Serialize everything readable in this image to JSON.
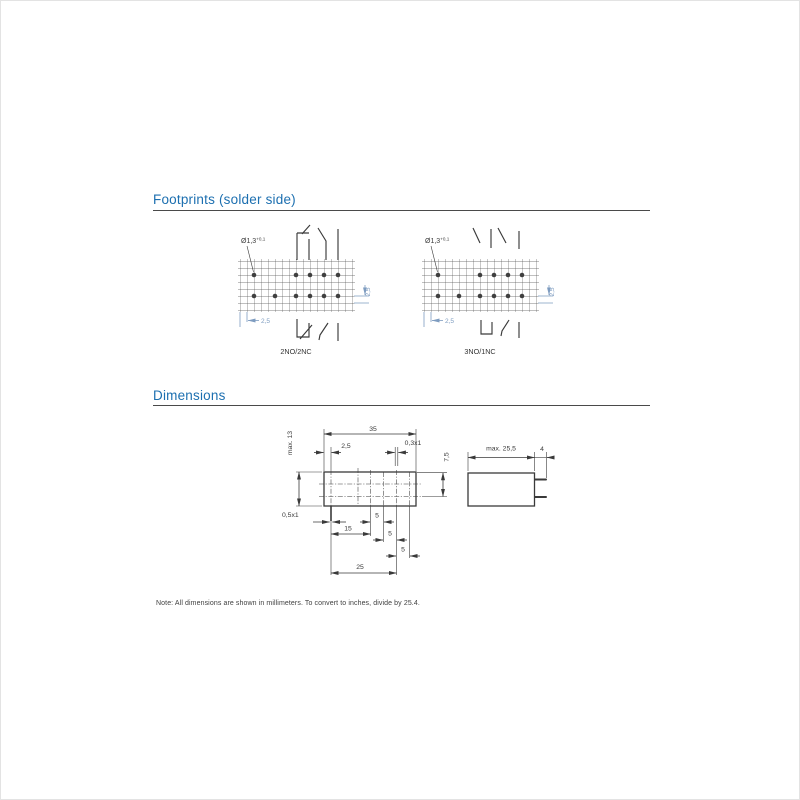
{
  "sections": {
    "footprints": {
      "title": "Footprints (solder side)"
    },
    "dimensions": {
      "title": "Dimensions"
    }
  },
  "footprints": {
    "left": {
      "label": "2NO/2NC",
      "hole": "Ø1,3",
      "hole_tol": "+0,1",
      "pitch_x": "2,5",
      "pitch_y": "2,5"
    },
    "right": {
      "label": "3NO/1NC",
      "hole": "Ø1,3",
      "hole_tol": "+0,1",
      "pitch_x": "2,5",
      "pitch_y": "2,5"
    }
  },
  "dimensions": {
    "top_view": {
      "overall_width": "35",
      "pin_inset": "2,5",
      "pin_cross_top": "0,3x1",
      "row_pitch": "7,5",
      "overall_height": "max. 13",
      "pin_cross_left": "0,5x1",
      "pitch_15": "15",
      "pitches": [
        "5",
        "5",
        "5"
      ],
      "overall_span": "25"
    },
    "side_view": {
      "overall_length": "max. 25,5",
      "pin_length": "4"
    }
  },
  "note": {
    "text": "Note: All dimensions are shown in millimeters. To convert to inches, divide by 25.4."
  },
  "colors": {
    "heading": "#1c6fb0",
    "line": "#3a3a3a",
    "dim_accent": "#7e9cc0"
  }
}
